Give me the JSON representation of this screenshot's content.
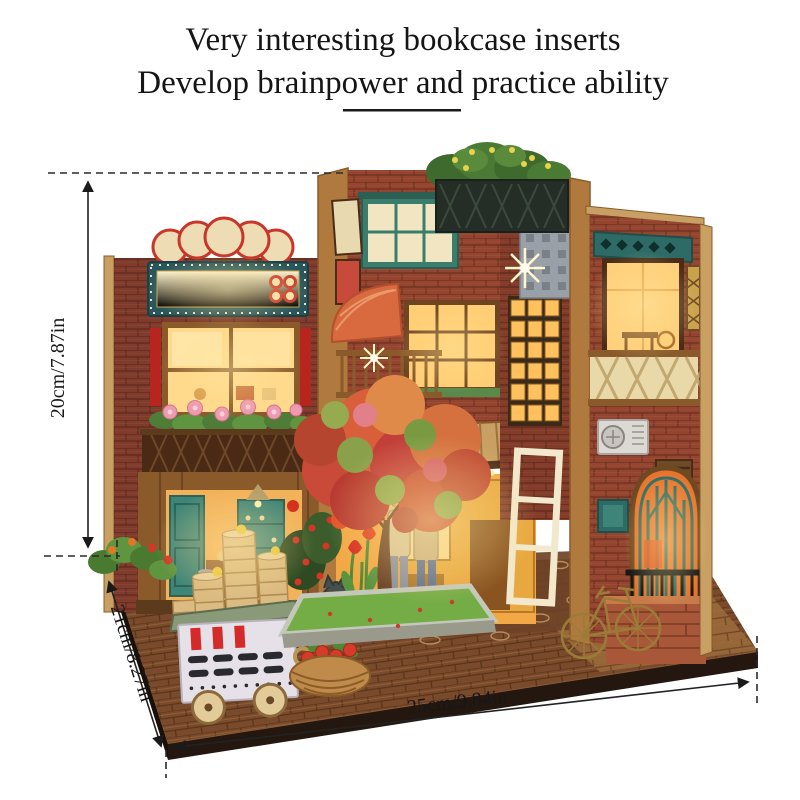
{
  "header": {
    "title_line1": "Very interesting bookcase inserts",
    "title_line2": "Develop brainpower and practice ability"
  },
  "dimensions": {
    "height": "20cm/7.87in",
    "depth": "21cm/8.27in",
    "width": "25cm/9.84in"
  },
  "scene": {
    "alt": "DIY miniature bookcase insert diorama: lantern-lit brick alley shops with glowing signboard, red blossom tree, two figures, dim-sum steamer cart, fruit basket, brass bicycle and arched doorway on a wooden brick-paved base"
  },
  "colors": {
    "background": "#ffffff",
    "annotation": "#1a1a1a",
    "brick": "#7f3b2c",
    "brick2": "#94452f",
    "glow": "#ffd98c",
    "teal": "#2e6b66",
    "wood": "#8a5a2b",
    "woodlight": "#c9a063",
    "cream": "#ede1b8",
    "basetop": "#7a4a2c",
    "baseface": "#241710",
    "accentred": "#c8362a"
  }
}
